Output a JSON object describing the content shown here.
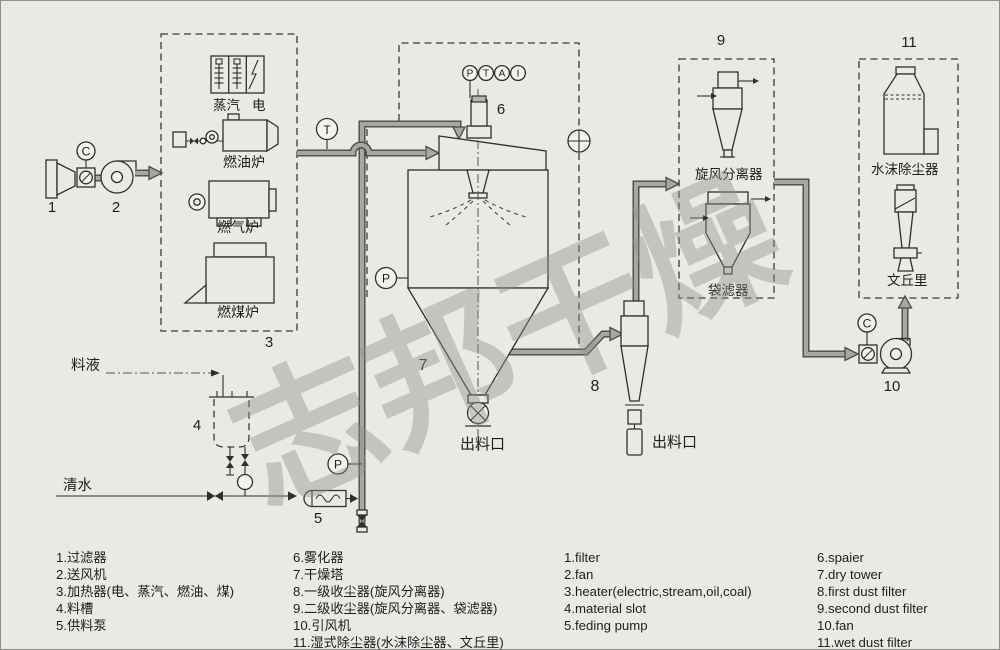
{
  "watermark": "志邦干燥",
  "colors": {
    "background": "#eae9e5",
    "line": "#2f2f2e",
    "pipe_fill": "#a8a7a3",
    "pipe_edge": "#4a4a48",
    "watermark": "#90908e"
  },
  "equipment": {
    "n1": "1",
    "n2": "2",
    "n3": "3",
    "n4": "4",
    "n5": "5",
    "n6": "6",
    "n7": "7",
    "n8": "8",
    "n9": "9",
    "n10": "10",
    "n11": "11",
    "steam": "蒸汽",
    "electric": "电",
    "oil_furnace": "燃油炉",
    "gas_furnace": "燃气炉",
    "coal_furnace": "燃煤炉",
    "cyclone_separator": "旋风分离器",
    "bag_filter": "袋滤器",
    "water_mist_collector": "水沫除尘器",
    "venturi": "文丘里",
    "material_liquid": "料液",
    "clean_water": "清水",
    "tower_outlet": "出料口",
    "cyclone_outlet": "出料口"
  },
  "instruments": {
    "c_inlet": "C",
    "t_air": "T",
    "p_tower": "P",
    "p_feed": "P",
    "c_outlet": "C",
    "ptai": [
      "P",
      "T",
      "A",
      "I"
    ]
  },
  "legend": {
    "col1": [
      "1.过滤器",
      "2.送风机",
      "3.加热器(电、蒸汽、燃油、煤)",
      "4.料槽",
      "5.供料泵"
    ],
    "col2": [
      "6.雾化器",
      "7.干燥塔",
      "8.一级收尘器(旋风分离器)",
      "9.二级收尘器(旋风分离器、袋滤器)",
      "10.引风机",
      "11.湿式除尘器(水沫除尘器、文丘里)"
    ],
    "col3": [
      "1.filter",
      "2.fan",
      "3.heater(electric,stream,oil,coal)",
      "4.material slot",
      "5.feding pump"
    ],
    "col4": [
      "6.spaier",
      "7.dry tower",
      "8.first dust filter",
      "9.second dust filter",
      "10.fan",
      "11.wet dust filter"
    ]
  }
}
